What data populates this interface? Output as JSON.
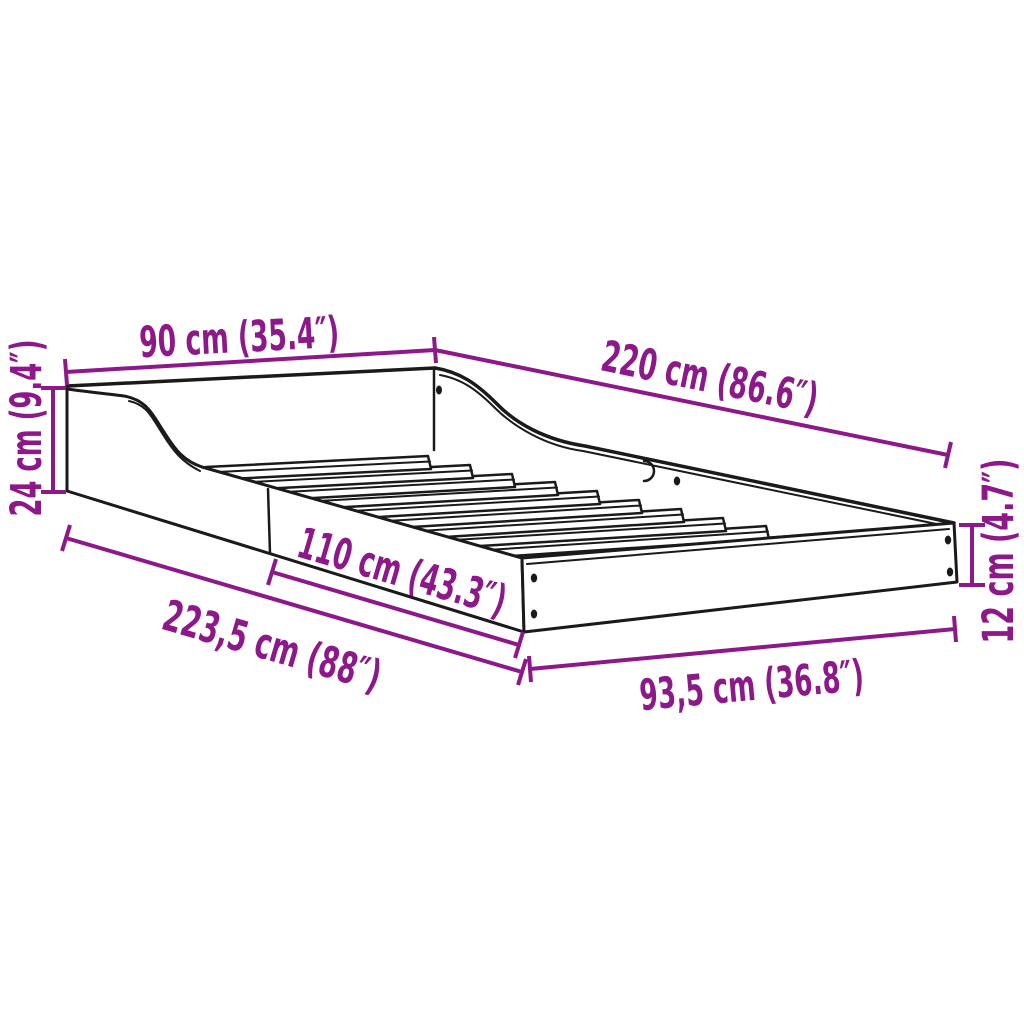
{
  "diagram": {
    "type": "product-dimension-diagram",
    "subject": "bed-frame-with-slatted-base",
    "slat_count": 10,
    "colors": {
      "dimension": "#8D1889",
      "line": "#1a1a1a",
      "background": "#ffffff"
    },
    "dimensions": [
      {
        "id": "head-width",
        "label": "90 cm (35.4″)"
      },
      {
        "id": "side-length-top",
        "label": "220 cm (86.6″)"
      },
      {
        "id": "headboard-height",
        "label": "24 cm (9.4″)"
      },
      {
        "id": "side-rail-length",
        "label": "110 cm (43.3″)"
      },
      {
        "id": "overall-length",
        "label": "223,5 cm (88″)"
      },
      {
        "id": "foot-width",
        "label": "93,5 cm (36.8″)"
      },
      {
        "id": "foot-height",
        "label": "12 cm (4.7″)"
      }
    ]
  }
}
